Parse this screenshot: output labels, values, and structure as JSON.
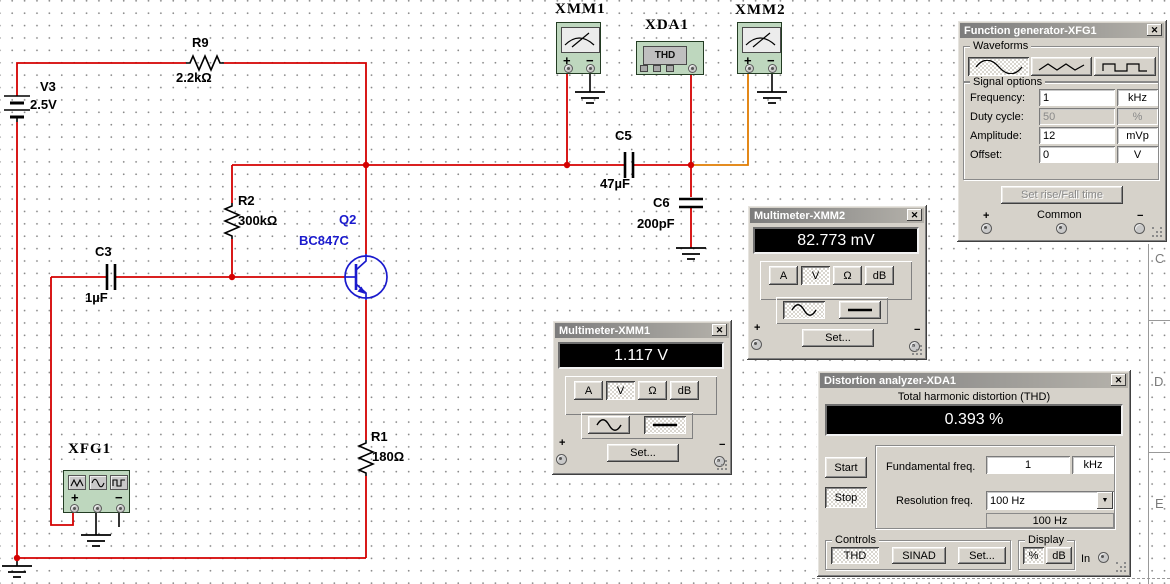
{
  "chrome": {
    "close": "✕",
    "dropdown": "▼"
  },
  "canvas": {
    "components": {
      "v3": {
        "ref": "V3",
        "value": "2.5V"
      },
      "r9": {
        "ref": "R9",
        "value": "2.2kΩ"
      },
      "r2": {
        "ref": "R2",
        "value": "300kΩ"
      },
      "r1": {
        "ref": "R1",
        "value": "180Ω"
      },
      "c3": {
        "ref": "C3",
        "value": "1µF"
      },
      "c5": {
        "ref": "C5",
        "value": "47µF"
      },
      "c6": {
        "ref": "C6",
        "value": "200pF"
      },
      "q2": {
        "ref": "Q2",
        "value": "BC847C"
      }
    },
    "instruments": {
      "xmm1": {
        "ref": "XMM1",
        "plus": "+",
        "minus": "−"
      },
      "xmm2": {
        "ref": "XMM2",
        "plus": "+",
        "minus": "−"
      },
      "xda1": {
        "ref": "XDA1",
        "display": "THD"
      },
      "xfg1": {
        "ref": "XFG1",
        "plus": "+",
        "minus": "−"
      }
    },
    "zones": [
      "C",
      "D",
      "E"
    ],
    "colors": {
      "wire_red": "#d40000",
      "wire_orange": "#e07c00",
      "component_blue": "#1a1acd",
      "instrument_green": "#bed7be"
    }
  },
  "windows": {
    "xfg1": {
      "title": "Function generator-XFG1",
      "waveforms_label": "Waveforms",
      "signal_options_label": "Signal options",
      "fields": [
        {
          "label": "Frequency:",
          "value": "1",
          "unit": "kHz"
        },
        {
          "label": "Duty cycle:",
          "value": "50",
          "unit": "%"
        },
        {
          "label": "Amplitude:",
          "value": "12",
          "unit": "mVp"
        },
        {
          "label": "Offset:",
          "value": "0",
          "unit": "V"
        }
      ],
      "set_rise_fall": "Set rise/Fall time",
      "plus": "+",
      "common": "Common",
      "minus": "−"
    },
    "xmm1": {
      "title": "Multimeter-XMM1",
      "reading": "1.117 V",
      "buttons": [
        "A",
        "V",
        "Ω",
        "dB"
      ],
      "set_label": "Set...",
      "plus": "+",
      "minus": "−"
    },
    "xmm2": {
      "title": "Multimeter-XMM2",
      "reading": "82.773 mV",
      "buttons": [
        "A",
        "V",
        "Ω",
        "dB"
      ],
      "set_label": "Set...",
      "plus": "+",
      "minus": "−"
    },
    "xda1": {
      "title": "Distortion analyzer-XDA1",
      "thd_label": "Total harmonic distortion (THD)",
      "reading": "0.393 %",
      "start": "Start",
      "stop": "Stop",
      "fundamental_label": "Fundamental freq.",
      "fundamental_value": "1",
      "fundamental_unit": "kHz",
      "resolution_label": "Resolution freq.",
      "resolution_value": "100 Hz",
      "resolution_sub": "100 Hz",
      "controls_label": "Controls",
      "thd_btn": "THD",
      "sinad_btn": "SINAD",
      "set_btn": "Set...",
      "display_label": "Display",
      "pct_btn": "%",
      "db_btn": "dB",
      "in_label": "In"
    }
  }
}
